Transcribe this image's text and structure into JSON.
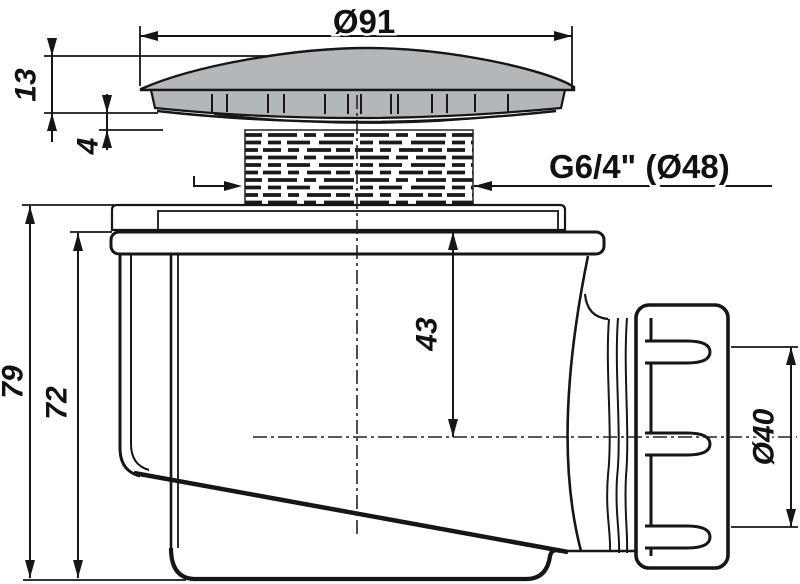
{
  "drawing": {
    "type_note": "technical section drawing of shower drain trap",
    "colors": {
      "background": "#ffffff",
      "line": "#161616",
      "cap_fill": "#b3b7b9"
    },
    "dims": {
      "top_diameter": "Ø91",
      "cap_height": "13",
      "cap_lip": "4",
      "thread_spec": "G6/4\" (Ø48)",
      "flange_to_axis_depth": "43",
      "total_height": "79",
      "body_height": "72",
      "outlet_diameter": "Ø40"
    }
  }
}
